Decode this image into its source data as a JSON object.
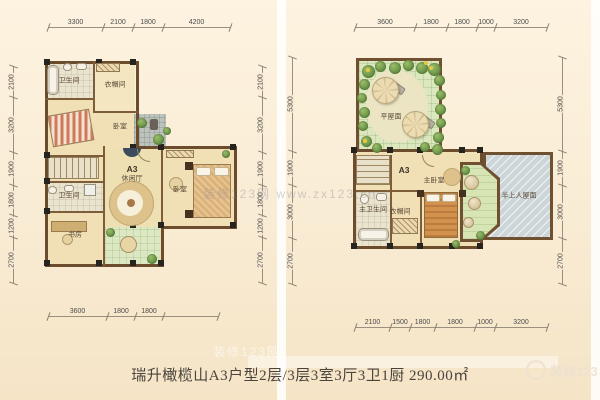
{
  "caption": "瑞升橄榄山A3户型2层/3层3室3厅3卫1厨 290.00㎡",
  "watermarks": {
    "center": "装修123网 www.zx123.cn",
    "lower": "装修123网",
    "corner": "装修123"
  },
  "colors": {
    "background": "#f8ead3",
    "wall": "#6b4c2c",
    "floor_wood": "#f1dfb6",
    "floor_tile": "#eae4cf",
    "garden_green": "#dbe7bd",
    "terrace_gray": "#ccd6d8",
    "dim_text": "#4c4c4c"
  },
  "left_plan": {
    "rooms": [
      {
        "name": "bathroom",
        "label": "卫生间",
        "x": 69,
        "y": 81
      },
      {
        "name": "cloakroom",
        "label": "衣帽间",
        "x": 115,
        "y": 85
      },
      {
        "name": "bedroom",
        "label": "卧室",
        "x": 120,
        "y": 127
      },
      {
        "name": "unit-a3",
        "label": "A3",
        "x": 132,
        "y": 169,
        "cls": "title"
      },
      {
        "name": "leisure-hall",
        "label": "休闲厅",
        "x": 132,
        "y": 179
      },
      {
        "name": "bedroom-2",
        "label": "卧室",
        "x": 180,
        "y": 190
      },
      {
        "name": "bathroom-2",
        "label": "卫生间",
        "x": 69,
        "y": 196
      },
      {
        "name": "study",
        "label": "书房",
        "x": 75,
        "y": 235
      }
    ],
    "dims": [
      {
        "name": "top",
        "axis": "h",
        "pos": 28,
        "start": 48,
        "segments": [
          {
            "label": "3300",
            "span": 55
          },
          {
            "label": "2100",
            "span": 30
          },
          {
            "label": "1800",
            "span": 30
          },
          {
            "label": "4200",
            "span": 67
          }
        ]
      },
      {
        "name": "bottom",
        "axis": "h",
        "pos": 317,
        "start": 48,
        "segments": [
          {
            "label": "3600",
            "span": 59
          },
          {
            "label": "1800",
            "span": 28
          },
          {
            "label": "1800",
            "span": 28
          },
          {
            "label": "",
            "span": 55
          }
        ]
      },
      {
        "name": "left",
        "axis": "v",
        "pos": 14,
        "start": 66,
        "segments": [
          {
            "label": "2100",
            "span": 31
          },
          {
            "label": "3200",
            "span": 55
          },
          {
            "label": "1900",
            "span": 33
          },
          {
            "label": "1800",
            "span": 30
          },
          {
            "label": "1200",
            "span": 22
          },
          {
            "label": "2700",
            "span": 46
          }
        ]
      },
      {
        "name": "right",
        "axis": "v",
        "pos": 263,
        "start": 66,
        "segments": [
          {
            "label": "2100",
            "span": 31
          },
          {
            "label": "3200",
            "span": 55
          },
          {
            "label": "1900",
            "span": 33
          },
          {
            "label": "1800",
            "span": 30
          },
          {
            "label": "1200",
            "span": 22
          },
          {
            "label": "2700",
            "span": 46
          }
        ]
      }
    ]
  },
  "right_plan": {
    "rooms": [
      {
        "name": "flat-roof",
        "label": "平屋面",
        "x": 391,
        "y": 117
      },
      {
        "name": "unit-a3",
        "label": "A3",
        "x": 404,
        "y": 170,
        "cls": "title"
      },
      {
        "name": "master-bedroom",
        "label": "主卧室",
        "x": 434,
        "y": 181
      },
      {
        "name": "master-bathroom",
        "label": "主卫生间",
        "x": 373,
        "y": 210
      },
      {
        "name": "cloakroom",
        "label": "衣帽间",
        "x": 400,
        "y": 212
      },
      {
        "name": "semi-accessible-roof",
        "label": "半上人屋面",
        "x": 519,
        "y": 196
      }
    ],
    "dims": [
      {
        "name": "top",
        "axis": "h",
        "pos": 28,
        "start": 355,
        "segments": [
          {
            "label": "3600",
            "span": 60
          },
          {
            "label": "1800",
            "span": 32
          },
          {
            "label": "1800",
            "span": 30
          },
          {
            "label": "1000",
            "span": 18
          },
          {
            "label": "3200",
            "span": 52
          }
        ]
      },
      {
        "name": "bottom",
        "axis": "h",
        "pos": 328,
        "start": 355,
        "segments": [
          {
            "label": "2100",
            "span": 35
          },
          {
            "label": "1500",
            "span": 20
          },
          {
            "label": "1800",
            "span": 25
          },
          {
            "label": "1800",
            "span": 40
          },
          {
            "label": "1000",
            "span": 20
          },
          {
            "label": "3200",
            "span": 52
          }
        ]
      },
      {
        "name": "left",
        "axis": "v",
        "pos": 293,
        "start": 57,
        "segments": [
          {
            "label": "5300",
            "span": 94
          },
          {
            "label": "1900",
            "span": 34
          },
          {
            "label": "3000",
            "span": 53
          },
          {
            "label": "2700",
            "span": 46
          }
        ]
      },
      {
        "name": "right",
        "axis": "v",
        "pos": 563,
        "start": 57,
        "segments": [
          {
            "label": "5300",
            "span": 94
          },
          {
            "label": "1900",
            "span": 34
          },
          {
            "label": "3000",
            "span": 53
          },
          {
            "label": "2700",
            "span": 46
          }
        ]
      }
    ]
  }
}
